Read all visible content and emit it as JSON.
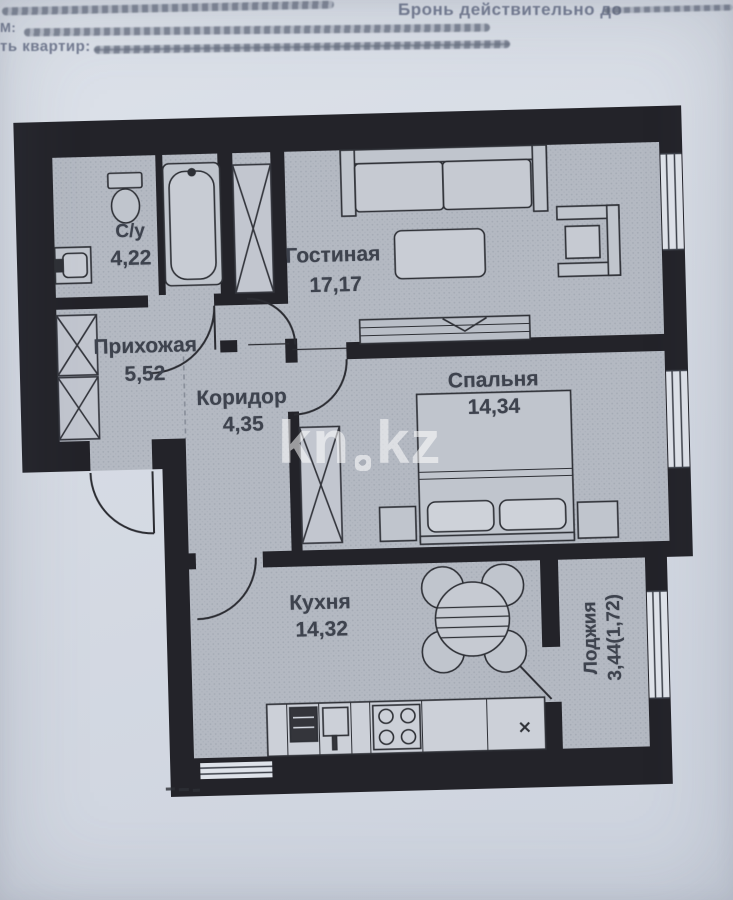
{
  "header": {
    "right_text": "Бронь действительно до",
    "left_prefix_1": "М:",
    "left_prefix_2": "ть квартир:"
  },
  "watermark": {
    "part1": "kn",
    "part2": "kz"
  },
  "rooms": [
    {
      "id": "bathroom",
      "name": "С/у",
      "area": "4,22"
    },
    {
      "id": "living",
      "name": "Гостиная",
      "area": "17,17"
    },
    {
      "id": "hallway",
      "name": "Прихожая",
      "area": "5,52"
    },
    {
      "id": "corridor",
      "name": "Коридор",
      "area": "4,35"
    },
    {
      "id": "bedroom",
      "name": "Спальня",
      "area": "14,34"
    },
    {
      "id": "kitchen",
      "name": "Кухня",
      "area": "14,32"
    },
    {
      "id": "loggia",
      "name": "Лоджия",
      "area": "3,44(1,72)"
    }
  ],
  "colors": {
    "paper": "#d6dbe4",
    "floor": "#b4b9c2",
    "wall": "#232329",
    "label": "#3e434e",
    "watermark": "rgba(255,255,255,0.55)"
  }
}
